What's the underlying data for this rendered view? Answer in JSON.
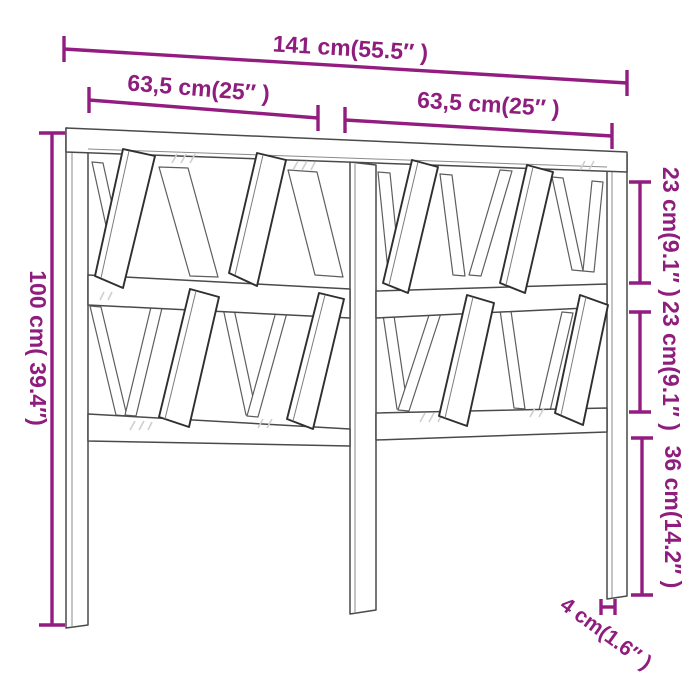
{
  "page": {
    "background": "#ffffff",
    "description": "Line-drawing dimension diagram of a slatted wooden headboard with V-shaped slat design"
  },
  "colors": {
    "dimension_accent": "#931c80",
    "drawing_outline": "#4a4a4a"
  },
  "dimensions": {
    "total_width": "141 cm(55.5″ )",
    "left_section_width": "63,5 cm(25″ )",
    "right_section_width": "63,5 cm(25″ )",
    "total_height": "100 cm( 39.4″)",
    "upper_panel_height": "23 cm(9.1″ )",
    "middle_panel_height": "23 cm(9.1″ )",
    "leg_height": "36 cm(14.2″ )",
    "post_thickness": "4 cm(1.6″ )"
  }
}
